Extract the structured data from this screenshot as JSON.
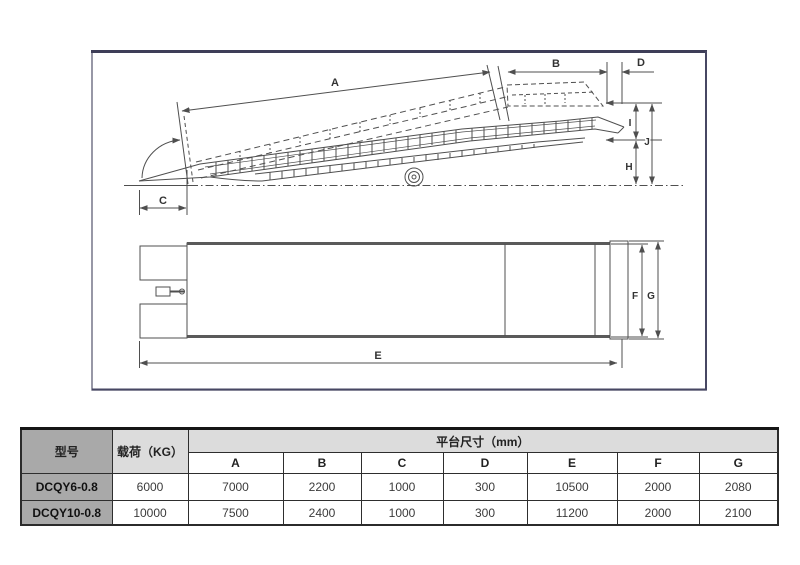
{
  "diagram": {
    "side_view": {
      "labels": {
        "A": "A",
        "B": "B",
        "C": "C",
        "D": "D",
        "H": "H",
        "I": "I",
        "J": "J"
      }
    },
    "top_view": {
      "labels": {
        "E": "E",
        "F": "F",
        "G": "G"
      }
    }
  },
  "table": {
    "headers": {
      "model": "型号",
      "load": "载荷（KG）",
      "platform_size": "平台尺寸（mm）",
      "dims": [
        "A",
        "B",
        "C",
        "D",
        "E",
        "F",
        "G"
      ]
    },
    "rows": [
      {
        "model": "DCQY6-0.8",
        "load": "6000",
        "dims": [
          "7000",
          "2200",
          "1000",
          "300",
          "10500",
          "2000",
          "2080"
        ]
      },
      {
        "model": "DCQY10-0.8",
        "load": "10000",
        "dims": [
          "7500",
          "2400",
          "1000",
          "300",
          "11200",
          "2000",
          "2100"
        ]
      }
    ]
  },
  "colors": {
    "panel_border": "#474763",
    "drawing_line": "#4f4f4f",
    "table_border": "#2b2b2b",
    "header_dark_bg": "#a9a9a9",
    "header_light_bg": "#dcdcdc",
    "cell_bg": "#ffffff",
    "text": "#333333"
  }
}
